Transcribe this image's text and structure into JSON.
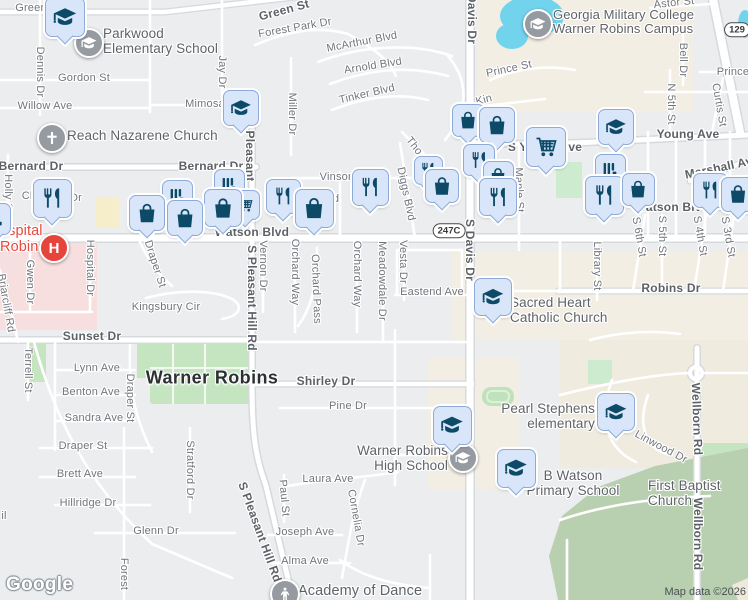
{
  "map": {
    "city_label": {
      "text": "Warner Robins",
      "x": 212,
      "y": 378
    },
    "attribution": {
      "logo": "Google",
      "map_data": "Map data ©2026"
    },
    "colors": {
      "land": "#ebedef",
      "road": "#ffffff",
      "road_casing": "#d6d9dd",
      "water": "#72d3ec",
      "park": "#c4e5c0",
      "forest": "#b9d0b0",
      "institutional_beige": "#f3eee3",
      "hospital_pink": "#f8dfdf",
      "commercial_yellow": "#f6eecb",
      "pin_fill": "#d9e6f9",
      "pin_border": "#8fabd8",
      "pin_glyph": "#0d4a68",
      "circle_gray": "#969ba1",
      "circle_red": "#e5453a",
      "street_label": "#70757c",
      "poi_label": "#5f6368",
      "hospital_label_red": "#e8483d"
    },
    "route_shields": [
      {
        "text": "247C",
        "x": 449,
        "y": 231
      },
      {
        "text": "129",
        "x": 737,
        "y": 30
      }
    ],
    "street_labels": [
      {
        "text": "Green St",
        "x": 38,
        "y": 8
      },
      {
        "text": "Green St",
        "x": 284,
        "y": 10,
        "rot": -15,
        "major": true
      },
      {
        "text": "Forest Park Dr",
        "x": 295,
        "y": 28,
        "rot": -10
      },
      {
        "text": "McArthur Blvd",
        "x": 362,
        "y": 42,
        "rot": -11
      },
      {
        "text": "Arnold Blvd",
        "x": 373,
        "y": 66,
        "rot": -9
      },
      {
        "text": "Tinker Blvd",
        "x": 367,
        "y": 94,
        "rot": -13
      },
      {
        "text": "Davis Dr",
        "x": 472,
        "y": 19,
        "rot": 90,
        "major": true
      },
      {
        "text": "Prince St",
        "x": 509,
        "y": 69,
        "rot": -12
      },
      {
        "text": "Prince St",
        "x": 740,
        "y": 72
      },
      {
        "text": "Astor St",
        "x": 674,
        "y": 3,
        "rot": -6
      },
      {
        "text": "Kin",
        "x": 484,
        "y": 100,
        "rot": -15
      },
      {
        "text": "Bell Dr",
        "x": 683,
        "y": 60,
        "rot": 90
      },
      {
        "text": "N 5th St",
        "x": 671,
        "y": 104,
        "rot": 90
      },
      {
        "text": "Curtis St",
        "x": 719,
        "y": 105,
        "rot": 80
      },
      {
        "text": "Dennis Dr",
        "x": 40,
        "y": 72,
        "rot": 90
      },
      {
        "text": "Jay Dr",
        "x": 222,
        "y": 72,
        "rot": 90
      },
      {
        "text": "Gordon St",
        "x": 84,
        "y": 78
      },
      {
        "text": "Willow Ave",
        "x": 45,
        "y": 106
      },
      {
        "text": "Mimosa",
        "x": 205,
        "y": 104
      },
      {
        "text": "Miller Dr",
        "x": 292,
        "y": 114,
        "rot": 90
      },
      {
        "text": "Bernard Dr",
        "x": 31,
        "y": 166,
        "major": true
      },
      {
        "text": "Bernard Dr",
        "x": 211,
        "y": 166,
        "major": true
      },
      {
        "text": "Holly St",
        "x": 8,
        "y": 194,
        "rot": 90
      },
      {
        "text": "Ch",
        "x": 29,
        "y": 196
      },
      {
        "text": "Dr",
        "x": 76,
        "y": 198
      },
      {
        "text": "Pleasant",
        "x": 250,
        "y": 156,
        "rot": 90,
        "major": true
      },
      {
        "text": "S Pleasant Hill Rd",
        "x": 252,
        "y": 298,
        "rot": 90,
        "major": true
      },
      {
        "text": "Vernon Dr",
        "x": 263,
        "y": 266,
        "rot": 90
      },
      {
        "text": "Orchard Way",
        "x": 295,
        "y": 272,
        "rot": 90
      },
      {
        "text": "Orchard Pass",
        "x": 316,
        "y": 289,
        "rot": 88
      },
      {
        "text": "Orchard Way",
        "x": 357,
        "y": 274,
        "rot": 90
      },
      {
        "text": "Meadowdale Dr",
        "x": 382,
        "y": 281,
        "rot": 90
      },
      {
        "text": "Vesta Dr",
        "x": 403,
        "y": 262,
        "rot": 90
      },
      {
        "text": "Diggs Blvd",
        "x": 406,
        "y": 194,
        "rot": 78
      },
      {
        "text": "Tho",
        "x": 414,
        "y": 146,
        "rot": 52
      },
      {
        "text": "Vinson",
        "x": 337,
        "y": 177
      },
      {
        "text": "d",
        "x": 336,
        "y": 199
      },
      {
        "text": "Watson Blvd",
        "x": 252,
        "y": 232,
        "major": true
      },
      {
        "text": "Watson Blvd",
        "x": 672,
        "y": 207,
        "major": true
      },
      {
        "text": "S Davis Dr",
        "x": 470,
        "y": 250,
        "rot": 90,
        "major": true
      },
      {
        "text": "S Young Ave",
        "x": 545,
        "y": 147,
        "major": true
      },
      {
        "text": "Young Ave",
        "x": 688,
        "y": 134,
        "major": true
      },
      {
        "text": "Marshall Ave",
        "x": 722,
        "y": 167,
        "rot": -12,
        "major": true
      },
      {
        "text": "Maple St",
        "x": 519,
        "y": 190,
        "rot": 88
      },
      {
        "text": "Library St",
        "x": 597,
        "y": 266,
        "rot": 90
      },
      {
        "text": "S 6th St",
        "x": 639,
        "y": 237,
        "rot": 80
      },
      {
        "text": "S 5th St",
        "x": 662,
        "y": 236,
        "rot": 90
      },
      {
        "text": "S 4th St",
        "x": 700,
        "y": 236,
        "rot": 80
      },
      {
        "text": "S 3rd St",
        "x": 728,
        "y": 237,
        "rot": 80
      },
      {
        "text": "Robins Dr",
        "x": 671,
        "y": 288,
        "major": true
      },
      {
        "text": "Eastend Ave",
        "x": 432,
        "y": 292
      },
      {
        "text": "Hospital Dr",
        "x": 90,
        "y": 268,
        "rot": 90
      },
      {
        "text": "Gwen Dr",
        "x": 30,
        "y": 282,
        "rot": 90
      },
      {
        "text": "Briarcliff Rd",
        "x": 6,
        "y": 303,
        "rot": 80
      },
      {
        "text": "Draper St",
        "x": 155,
        "y": 264,
        "rot": 72
      },
      {
        "text": "Kingsbury Cir",
        "x": 166,
        "y": 307
      },
      {
        "text": "Sunset Dr",
        "x": 92,
        "y": 336,
        "major": true
      },
      {
        "text": "Terrell St",
        "x": 28,
        "y": 370,
        "rot": 90
      },
      {
        "text": "Lynn Ave",
        "x": 97,
        "y": 368
      },
      {
        "text": "Benton Ave",
        "x": 91,
        "y": 392
      },
      {
        "text": "Sandra Ave",
        "x": 94,
        "y": 418
      },
      {
        "text": "Draper St",
        "x": 130,
        "y": 398,
        "rot": 90
      },
      {
        "text": "Draper St",
        "x": 83,
        "y": 446
      },
      {
        "text": "Shirley Dr",
        "x": 326,
        "y": 381,
        "major": true
      },
      {
        "text": "Pine Dr",
        "x": 348,
        "y": 406
      },
      {
        "text": "Stratford Dr",
        "x": 190,
        "y": 470,
        "rot": 90
      },
      {
        "text": "Laura Ave",
        "x": 328,
        "y": 479
      },
      {
        "text": "Paul St",
        "x": 284,
        "y": 498,
        "rot": 85
      },
      {
        "text": "Cornelia Dr",
        "x": 356,
        "y": 518,
        "rot": 80
      },
      {
        "text": "Joseph Ave",
        "x": 305,
        "y": 532
      },
      {
        "text": "Alma Ave",
        "x": 305,
        "y": 561
      },
      {
        "text": "Glenn Dr",
        "x": 156,
        "y": 531
      },
      {
        "text": "Hillridge Dr",
        "x": 88,
        "y": 503
      },
      {
        "text": "Brett Ave",
        "x": 80,
        "y": 474
      },
      {
        "text": "S Pleasant Hill Rd",
        "x": 260,
        "y": 532,
        "rot": 70,
        "major": true
      },
      {
        "text": "Forest",
        "x": 124,
        "y": 574,
        "rot": 90
      },
      {
        "text": "Linwood Dr",
        "x": 661,
        "y": 447,
        "rot": 28
      },
      {
        "text": "Wellborn Rd",
        "x": 697,
        "y": 419,
        "rot": 88,
        "major": true
      },
      {
        "text": "Wellborn Rd",
        "x": 698,
        "y": 534,
        "rot": 90,
        "major": true
      },
      {
        "text": "il",
        "x": 4,
        "y": 516
      }
    ],
    "poi_labels": [
      {
        "id": "parkwood-elementary-school",
        "lines": [
          "Parkwood",
          "Elementary School"
        ],
        "x": 103,
        "y": 27,
        "align": "left",
        "size": 13.5
      },
      {
        "id": "reach-nazarene-church",
        "lines": [
          "Reach Nazarene Church"
        ],
        "x": 67,
        "y": 129,
        "align": "left",
        "size": 13.5
      },
      {
        "id": "georgia-military-college",
        "lines": [
          "Georgia Military College",
          "Warner Robins Campus"
        ],
        "x": 553,
        "y": 8,
        "align": "left",
        "size": 13
      },
      {
        "id": "hospital-robins",
        "lines": [
          "ospital",
          "Robins"
        ],
        "x": 0,
        "y": 224,
        "align": "left",
        "size": 14.5,
        "color": "red"
      },
      {
        "id": "sacred-heart-catholic-church",
        "lines": [
          "Sacred Heart",
          "Catholic Church"
        ],
        "x": 510,
        "y": 296,
        "align": "left",
        "size": 13.5
      },
      {
        "id": "pearl-stephens-elementary",
        "lines": [
          "Pearl Stephens",
          "elementary"
        ],
        "x": 595,
        "y": 402,
        "align": "right",
        "size": 13.5
      },
      {
        "id": "warner-robins-high-school",
        "lines": [
          "Warner Robins",
          "High School"
        ],
        "x": 448,
        "y": 444,
        "align": "right",
        "size": 13.5
      },
      {
        "id": "b-watson-primary-school",
        "lines": [
          "B Watson",
          "Primary School"
        ],
        "x": 573,
        "y": 469,
        "align": "center",
        "size": 13.5
      },
      {
        "id": "first-baptist-church",
        "lines": [
          "First Baptist Church"
        ],
        "x": 648,
        "y": 479,
        "align": "left",
        "size": 13.5
      },
      {
        "id": "academy-of-dance",
        "lines": [
          "Academy of Dance"
        ],
        "x": 298,
        "y": 584,
        "align": "left",
        "size": 14.5
      }
    ],
    "pins": [
      {
        "icon": "school",
        "x": 64,
        "y": 16,
        "s": 38
      },
      {
        "icon": "school",
        "x": 240,
        "y": 107,
        "s": 34
      },
      {
        "icon": "restaurant",
        "x": 51,
        "y": 197,
        "s": 37
      },
      {
        "icon": "store",
        "x": -6,
        "y": 218,
        "s": 30
      },
      {
        "icon": "store",
        "x": 176,
        "y": 194,
        "s": 29
      },
      {
        "icon": "store",
        "x": 228,
        "y": 183,
        "s": 29
      },
      {
        "icon": "shopping-cart",
        "x": 244,
        "y": 204,
        "s": 28
      },
      {
        "icon": "shopping-bag",
        "x": 222,
        "y": 207,
        "s": 36
      },
      {
        "icon": "shopping-bag",
        "x": 146,
        "y": 212,
        "s": 34
      },
      {
        "icon": "shopping-bag",
        "x": 184,
        "y": 217,
        "s": 34
      },
      {
        "icon": "restaurant",
        "x": 282,
        "y": 195,
        "s": 33
      },
      {
        "icon": "shopping-bag",
        "x": 313,
        "y": 207,
        "s": 37
      },
      {
        "icon": "restaurant",
        "x": 369,
        "y": 186,
        "s": 35
      },
      {
        "icon": "restaurant",
        "x": 427,
        "y": 169,
        "s": 27
      },
      {
        "icon": "shopping-bag",
        "x": 441,
        "y": 185,
        "s": 32
      },
      {
        "icon": "shopping-bag",
        "x": 467,
        "y": 119,
        "s": 31
      },
      {
        "icon": "shopping-bag",
        "x": 496,
        "y": 124,
        "s": 34
      },
      {
        "icon": "restaurant",
        "x": 478,
        "y": 159,
        "s": 30
      },
      {
        "icon": "shopping-bag",
        "x": 497,
        "y": 175,
        "s": 29
      },
      {
        "icon": "restaurant",
        "x": 497,
        "y": 196,
        "s": 36
      },
      {
        "icon": "shopping-cart",
        "x": 545,
        "y": 146,
        "s": 38
      },
      {
        "icon": "school",
        "x": 615,
        "y": 126,
        "s": 34
      },
      {
        "icon": "store",
        "x": 609,
        "y": 168,
        "s": 29
      },
      {
        "icon": "restaurant",
        "x": 603,
        "y": 194,
        "s": 37
      },
      {
        "icon": "shopping-bag",
        "x": 637,
        "y": 188,
        "s": 31
      },
      {
        "icon": "restaurant",
        "x": 709,
        "y": 189,
        "s": 33
      },
      {
        "icon": "shopping-bag",
        "x": 737,
        "y": 193,
        "s": 33
      },
      {
        "icon": "school",
        "x": 492,
        "y": 296,
        "s": 36
      },
      {
        "icon": "school",
        "x": 451,
        "y": 424,
        "s": 37
      },
      {
        "icon": "school",
        "x": 515,
        "y": 467,
        "s": 37
      },
      {
        "icon": "school",
        "x": 615,
        "y": 411,
        "s": 36
      }
    ],
    "circle_markers": [
      {
        "icon": "school",
        "x": 87,
        "y": 41,
        "r": 13,
        "bg": "gray"
      },
      {
        "icon": "church-cross",
        "x": 50,
        "y": 136,
        "r": 13,
        "bg": "gray"
      },
      {
        "icon": "school",
        "x": 536,
        "y": 22,
        "r": 13,
        "bg": "gray"
      },
      {
        "icon": "school",
        "x": 461,
        "y": 456,
        "r": 13,
        "bg": "gray"
      },
      {
        "icon": "dance",
        "x": 283,
        "y": 592,
        "r": 13,
        "bg": "gray"
      },
      {
        "icon": "hospital-h",
        "letter": "H",
        "x": 52,
        "y": 246,
        "r": 13,
        "bg": "red"
      }
    ]
  }
}
